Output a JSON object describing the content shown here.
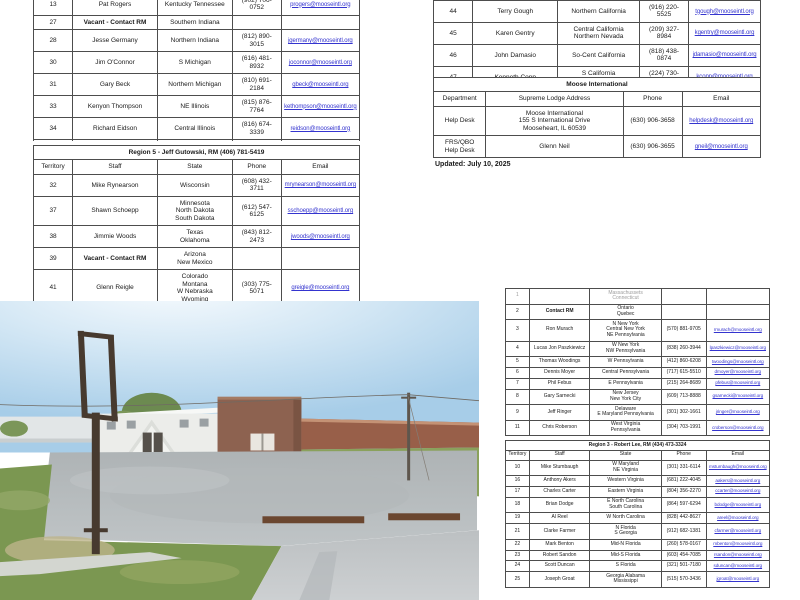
{
  "document": {
    "updated": "Updated: July 10, 2025"
  },
  "tables": {
    "top_left": {
      "widths": [
        "12%",
        "26%",
        "23%",
        "15%",
        "24%"
      ],
      "rows": [
        {
          "cells": [
            "13",
            "Pat Rogers",
            "Kentucky Tennessee",
            "(902) 706-0752",
            {
              "text": "progers@mooseintl.org",
              "link": true
            }
          ]
        },
        {
          "cells": [
            "27",
            {
              "text": "Vacant - Contact RM",
              "bold": true
            },
            "Southern Indiana",
            "",
            ""
          ]
        },
        {
          "cells": [
            "28",
            "Jesse Germany",
            "Northern Indiana",
            "(812) 890-3015",
            {
              "text": "jgermany@mooseintl.org",
              "link": true
            }
          ]
        },
        {
          "cells": [
            "30",
            "Jim O'Connor",
            "S Michigan",
            "(616) 481-8932",
            {
              "text": "joconnor@mooseintl.org",
              "link": true
            }
          ]
        },
        {
          "cells": [
            "31",
            "Gary Beck",
            "Northern Michigan",
            "(810) 691-2184",
            {
              "text": "gbeck@mooseintl.org",
              "link": true
            }
          ]
        },
        {
          "cells": [
            "33",
            "Kenyon Thompson",
            "NE Illinois",
            "(815) 876-7764",
            {
              "text": "kethompson@mooseintl.org",
              "link": true
            }
          ]
        },
        {
          "cells": [
            "34",
            "Richard Eidson",
            "Central Illinois",
            "(816) 674-3339",
            {
              "text": "reidson@mooseintl.org",
              "link": true
            }
          ]
        },
        {
          "cells": [
            "35",
            "Wendy Dodd",
            "Southern Illinois",
            "(618) 975-6442",
            {
              "text": "wdodd@mooseintl.org",
              "link": true
            }
          ]
        },
        {
          "cells": [
            "36",
            "David Scott",
            "Iowa\nMissouri",
            "(913) 207-5570",
            {
              "text": "dscott@mooseintl.org",
              "link": true
            }
          ]
        }
      ]
    },
    "top_right": {
      "widths": [
        "12%",
        "26%",
        "25%",
        "15%",
        "22%"
      ],
      "rows": [
        {
          "cells": [
            "44",
            "Terry Gough",
            "Northern California",
            "(916) 220-5525",
            {
              "text": "tgough@mooseintl.org",
              "link": true
            }
          ]
        },
        {
          "cells": [
            "45",
            "Karen Gentry",
            "Central California\nNorthern Nevada",
            "(209) 327-8984",
            {
              "text": "kgentry@mooseintl.org",
              "link": true
            }
          ]
        },
        {
          "cells": [
            "46",
            "John Damasio",
            "So-Cent California",
            "(818) 438-0874",
            {
              "text": "jdamasio@mooseintl.org",
              "link": true
            }
          ]
        },
        {
          "cells": [
            "47",
            "Kenneth Copp",
            "S California\nS Nevada",
            "(224) 730-9927",
            {
              "text": "kcopp@mooseintl.org",
              "link": true
            }
          ]
        }
      ]
    },
    "moose_international": {
      "title": "Moose International",
      "header": [
        "Department",
        "Supreme Lodge Address",
        "Phone",
        "Email"
      ],
      "widths": [
        "16%",
        "42%",
        "18%",
        "24%"
      ],
      "rows": [
        {
          "cells": [
            "Help Desk",
            "Moose International\n155 S International Drive\nMooseheart, IL 60539",
            "(630) 906-3658",
            {
              "text": "helpdesk@mooseintl.org",
              "link": true
            }
          ]
        },
        {
          "cells": [
            "FRS/QBO\nHelp Desk",
            "Glenn Neil",
            "(630) 906-3655",
            {
              "text": "gneil@mooseintl.org",
              "link": true
            }
          ]
        }
      ]
    },
    "region5": {
      "title": "Region 5 - Jeff Gutowski, RM (406) 781-5419",
      "header": [
        "Territory",
        "Staff",
        "State",
        "Phone",
        "Email"
      ],
      "widths": [
        "12%",
        "26%",
        "23%",
        "15%",
        "24%"
      ],
      "rows": [
        {
          "cells": [
            "32",
            "Mike Rynearson",
            "Wisconsin",
            "(608) 432-3711",
            {
              "text": "mrynearson@mooseintl.org",
              "link": true
            }
          ]
        },
        {
          "cells": [
            "37",
            "Shawn Schoepp",
            "Minnesota\nNorth Dakota\nSouth Dakota",
            "(612) 547-6125",
            {
              "text": "sschoepp@mooseintl.org",
              "link": true
            }
          ]
        },
        {
          "cells": [
            "38",
            "Jimmie Woods",
            "Texas\nOklahoma",
            "(843) 812-2473",
            {
              "text": "jwoods@mooseintl.org",
              "link": true
            }
          ]
        },
        {
          "cells": [
            "39",
            {
              "text": "Vacant - Contact RM",
              "bold": true
            },
            "Arizona\nNew Mexico",
            "",
            ""
          ]
        },
        {
          "cells": [
            "41",
            "Glenn Reigle",
            "Colorado\nMontana\nW Nebraska\nWyoming",
            "(303) 775-5071",
            {
              "text": "greigle@mooseintl.org",
              "link": true
            }
          ]
        }
      ]
    },
    "bottom_right_upper": {
      "widths": [
        "9%",
        "23%",
        "27%",
        "17%",
        "24%"
      ],
      "rows": [
        {
          "faint": true,
          "cells": [
            "1",
            "",
            "Massachussets\nConnecticut",
            "",
            ""
          ]
        },
        {
          "cells": [
            "2",
            {
              "text": "Contact RM",
              "bold": true
            },
            "Ontario\nQuebec",
            "",
            ""
          ]
        },
        {
          "cells": [
            "3",
            "Ron Murach",
            "N New York\nCentral New York\nNE Pennsylvania",
            "(570) 881-9705",
            {
              "text": "rmurach@mooseintl.org",
              "link": true
            }
          ]
        },
        {
          "cells": [
            "4",
            "Lucas Jon Paszkiewicz",
            "W New York\nNW Pennsylvania",
            "(838) 260-3944",
            {
              "text": "lpaszkiewicz@mooseintl.org",
              "link": true
            }
          ]
        },
        {
          "cells": [
            "5",
            "Thomas Woodings",
            "W Pennsylvania",
            "(412) 860-6208",
            {
              "text": "twoodings@mooseintl.org",
              "link": true
            }
          ]
        },
        {
          "cells": [
            "6",
            "Dennis Moyer",
            "Central Pennsylvania",
            "(717) 615-5510",
            {
              "text": "dmoyer@mooseintl.org",
              "link": true
            }
          ]
        },
        {
          "cells": [
            "7",
            "Phil Febus",
            "E Pennsylvania",
            "(215) 264-8689",
            {
              "text": "pfebus@mooseintl.org",
              "link": true
            }
          ]
        },
        {
          "cells": [
            "8",
            "Gary Sarnecki",
            "New Jersey\nNew York City",
            "(609) 713-8888",
            {
              "text": "gsarnecki@mooseintl.org",
              "link": true
            }
          ]
        },
        {
          "cells": [
            "9",
            "Jeff Ringer",
            "Delaware\nE Maryland Pennsylvania",
            "(301) 302-1661",
            {
              "text": "jringer@mooseintl.org",
              "link": true
            }
          ]
        },
        {
          "cells": [
            "11",
            "Chris Roberson",
            "West Virginia\nPennsylvania",
            "(304) 703-1991",
            {
              "text": "croberson@mooseintl.org",
              "link": true
            }
          ]
        }
      ]
    },
    "region3": {
      "title": "Region 3 - Robert Lee, RM (434) 473-3324",
      "header": [
        "Territory",
        "Staff",
        "State",
        "Phone",
        "Email"
      ],
      "widths": [
        "9%",
        "23%",
        "27%",
        "17%",
        "24%"
      ],
      "rows": [
        {
          "cells": [
            "10",
            "Mike Stumbaugh",
            "W Maryland\nNE Virginia",
            "(301) 331-6114",
            {
              "text": "mstumbaugh@mooseintl.org",
              "link": true
            }
          ]
        },
        {
          "cells": [
            "16",
            "Anthony Akers",
            "Western Virginia",
            "(681) 222-4045",
            {
              "text": "aakers@mooseintl.org",
              "link": true
            }
          ]
        },
        {
          "cells": [
            "17",
            "Charles Carter",
            "Eastern Virginia",
            "(804) 356-2270",
            {
              "text": "ccarter@mooseintl.org",
              "link": true
            }
          ]
        },
        {
          "cells": [
            "18",
            "Brian Dodge",
            "E North Carolina\nSouth Carolina",
            "(864) 597-6294",
            {
              "text": "bdodge@mooseintl.org",
              "link": true
            }
          ]
        },
        {
          "cells": [
            "19",
            "Al Reel",
            "W North Carolina",
            "(828) 442-8627",
            {
              "text": "areel@mooseintl.org",
              "link": true
            }
          ]
        },
        {
          "cells": [
            "21",
            "Clarke Farmer",
            "N Florida\nS Georgia",
            "(912) 682-1381",
            {
              "text": "cfarmer@mooseintl.org",
              "link": true
            }
          ]
        },
        {
          "cells": [
            "22",
            "Mark Benton",
            "Mid-N Florida",
            "(260) 578-0167",
            {
              "text": "mbenton@mooseintl.org",
              "link": true
            }
          ]
        },
        {
          "cells": [
            "23",
            "Robert Sandon",
            "Mid-S Florida",
            "(603) 454-7085",
            {
              "text": "rsandon@mooseintl.org",
              "link": true
            }
          ]
        },
        {
          "cells": [
            "24",
            "Scott Duncan",
            "S Florida",
            "(321) 501-7180",
            {
              "text": "sduncan@mooseintl.org",
              "link": true
            }
          ]
        },
        {
          "cells": [
            "25",
            "Joseph Groat",
            "Georgia Alabama\nMississippi",
            "(515) 570-3436",
            {
              "text": "jgroat@mooseintl.org",
              "link": true
            }
          ]
        }
      ]
    }
  },
  "photo": {
    "description": "Street-level photo of a white lodge building with a brown addition, long brown fence, gravel parking lot, grass foreground and an empty sign frame on a rusted pole",
    "palette": {
      "sky": "#aed2ea",
      "sky_glare": "#f4fafe",
      "building_white": "#ecedea",
      "building_brown": "#8d6250",
      "fence_brown": "#985f49",
      "gravel": "#b6bbbd",
      "grass": "#7b9751",
      "dry_grass": "#bdb489",
      "pole_dark": "#473a2f"
    }
  }
}
